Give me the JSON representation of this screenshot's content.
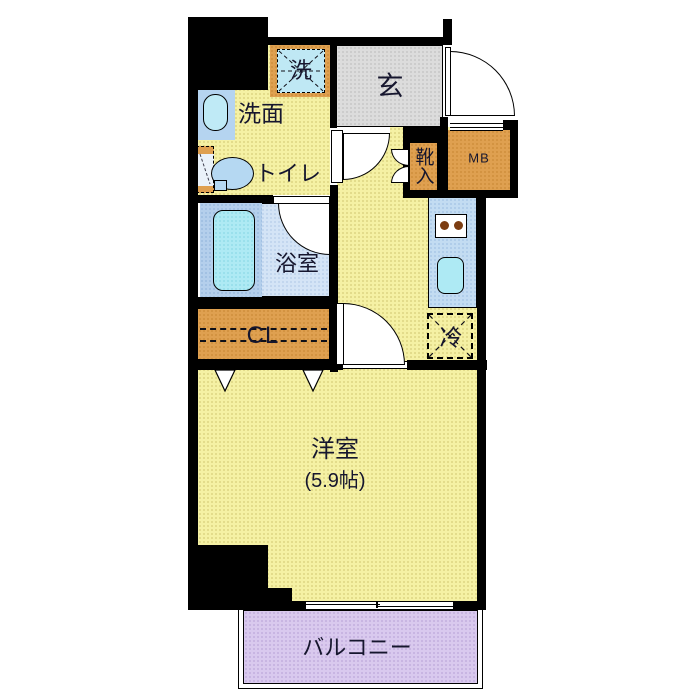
{
  "plan": {
    "title": "apartment-floor-plan",
    "rooms": {
      "washer": {
        "label": "洗"
      },
      "entrance": {
        "label": "玄"
      },
      "washroom": {
        "label": "洗面"
      },
      "toilet": {
        "label": "トイレ"
      },
      "shoe_box": {
        "label": "靴入"
      },
      "meter_box": {
        "label": "MB"
      },
      "bathroom": {
        "label": "浴室"
      },
      "closet": {
        "label": "CL"
      },
      "refrigerator": {
        "label": "冷"
      },
      "main_room": {
        "label": "洋室",
        "size": "(5.9帖)"
      },
      "balcony": {
        "label": "バルコニー"
      }
    },
    "colors": {
      "floor_yellow": "#f5f1a4",
      "entrance_gray": "#dcdcdc",
      "wood_orange": "#dfa050",
      "counter_blue": "#c3dcf2",
      "bath_blue": "#d4e4f6",
      "tub_panel_blue": "#b4cfec",
      "fixture_cyan": "#aeeaf4",
      "toilet_blue": "#b5d8f2",
      "balcony_purple": "#d9c9ee",
      "wall_black": "#000000",
      "text_dark": "#16162e",
      "burner_brown": "#7c3d12"
    }
  }
}
